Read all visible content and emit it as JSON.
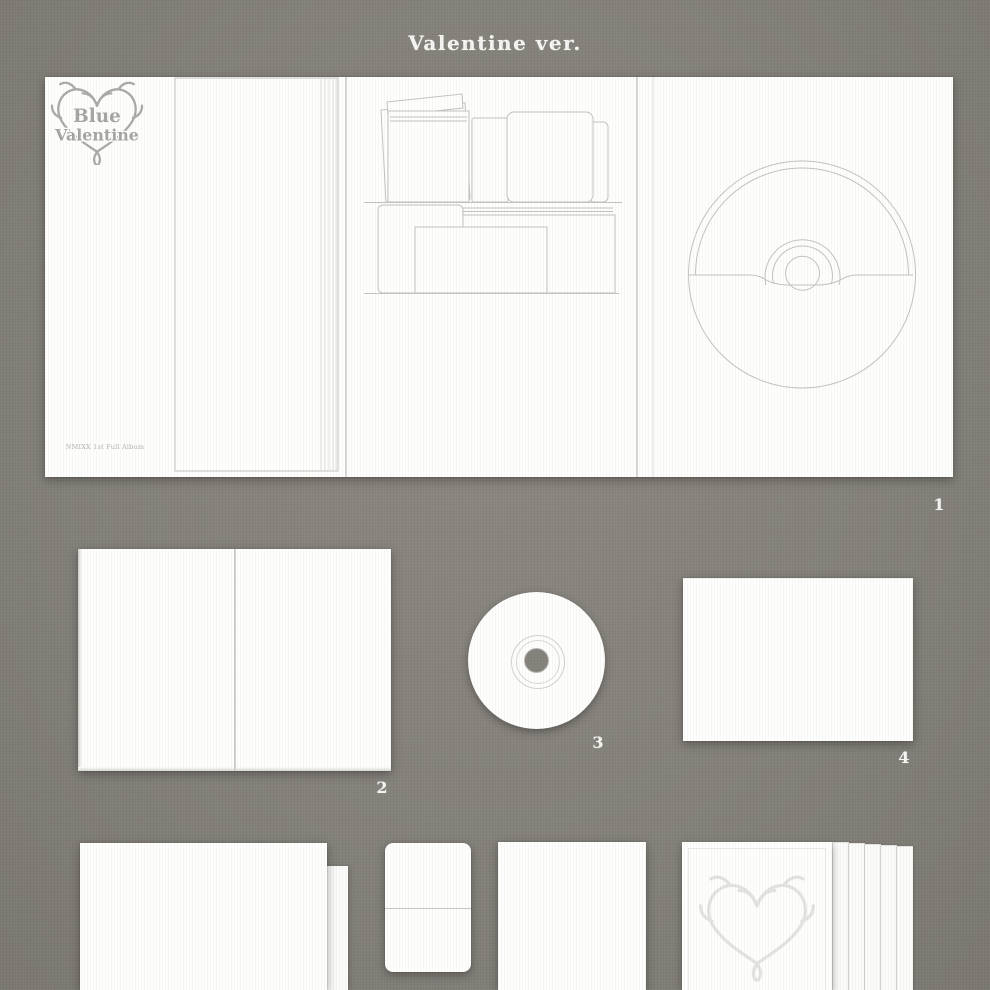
{
  "page": {
    "title": "Valentine ver."
  },
  "logo": {
    "line1": "Blue",
    "line2": "Valentine",
    "caption": "NMIXX 1st Full Album"
  },
  "item_numbers": [
    "1",
    "2",
    "3",
    "4"
  ],
  "colors": {
    "background": "#84817b",
    "surface": "#fefefd",
    "line_art": "#c3c3c0",
    "logo_gray": "#a9a9a6",
    "number_label": "#f6f5f2"
  }
}
